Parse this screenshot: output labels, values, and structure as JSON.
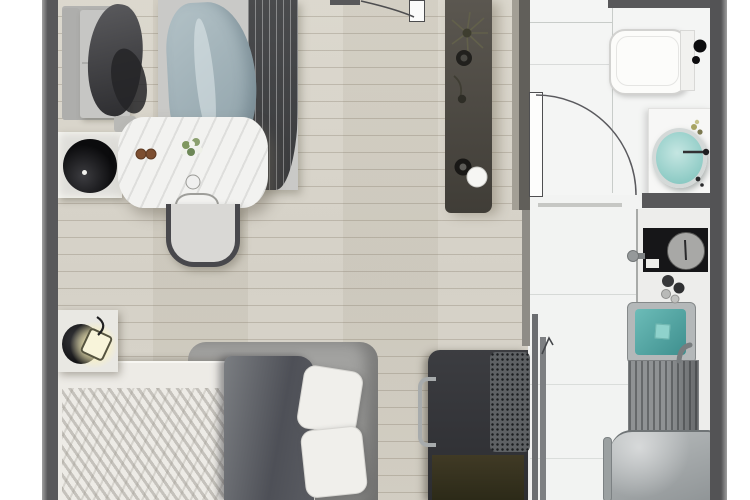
{
  "scene": {
    "type": "floor-plan",
    "description": "Top-down 3D rendering of a studio apartment floor plan, no visible text labels",
    "visible_text": [],
    "rooms": [
      {
        "name": "living-dining-area",
        "floor": "light wood planks",
        "objects": [
          "sofa with dark throw blanket",
          "wardrobe with hanging clothes and blue-grey drape",
          "white marble dining table",
          "flower bouquet",
          "two brown coasters",
          "dining chair",
          "tucked chair with glass",
          "black round side table",
          "entry console with plant, vases, ring and sphere decor",
          "entry door with swing arc"
        ]
      },
      {
        "name": "bedroom-area",
        "floor": "light wood planks",
        "objects": [
          "double bed with grey upholstered frame",
          "white duvet with knit throw",
          "dark grey folded blanket",
          "two white pillows",
          "nightstand with lit lamp and black dish",
          "desk with drawer handle",
          "speckled desk chair cushion",
          "dark lower shelf",
          "sliding door panels"
        ]
      },
      {
        "name": "bathroom",
        "floor": "white tile",
        "objects": [
          "toilet with tank and black flush buttons",
          "vanity counter",
          "mint oval wash basin",
          "wall faucet",
          "flower sprig",
          "inward swinging door with arc"
        ]
      },
      {
        "name": "kitchen-hallway",
        "floor": "white tile",
        "objects": [
          "white counter run",
          "black cooktop with large grey dial",
          "side knob",
          "four burner control knobs",
          "stainless sink with teal water basin",
          "ridged drain board",
          "refrigerator with handle"
        ]
      }
    ],
    "palette": {
      "wall": "#58585a",
      "wood_floor": "#d6d2c7",
      "tile_floor": "#f3f4f3",
      "counter": "#ededeb",
      "accent_teal": "#5fb4b0",
      "basin_mint": "#a9dbd5",
      "cooktop_black": "#161618",
      "bed_frame_grey": "#9c9c9a",
      "duvet_white": "#edebe6",
      "blanket_dark": "#53555b",
      "drape_blue": "#9fb3ba",
      "console_brown": "#4d4a43",
      "lamp_glow": "#fdf3c0"
    }
  }
}
